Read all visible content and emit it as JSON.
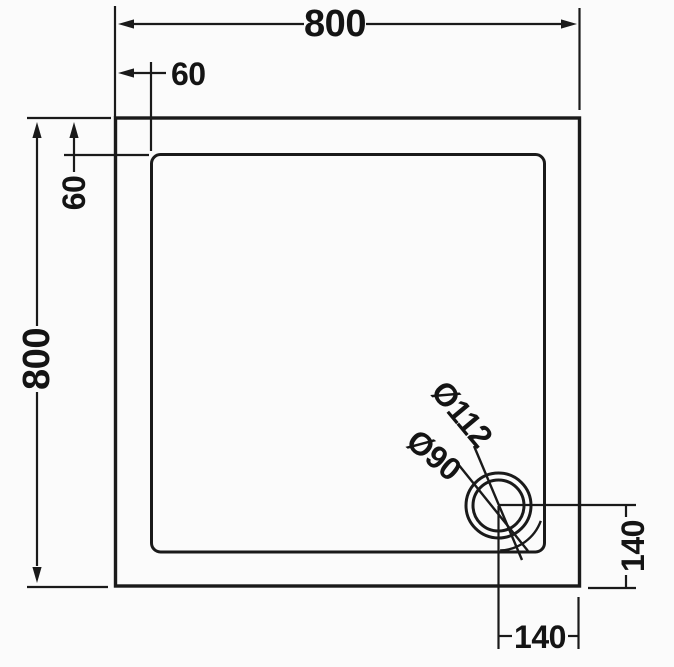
{
  "drawing": {
    "subject": "square shower tray plan view with offset round waste",
    "colors": {
      "line": "#1a1a1a",
      "background": "#fbfbfb",
      "tray_fill": "#fdfdfd"
    }
  },
  "dims": {
    "overall_width": "800",
    "overall_depth": "800",
    "rim_inset_top": "60",
    "rim_inset_left": "60",
    "waste": {
      "outer_diameter": "Ø112",
      "inner_diameter": "Ø90",
      "center_to_bottom_edge": "140",
      "center_to_right_edge": "140"
    }
  }
}
